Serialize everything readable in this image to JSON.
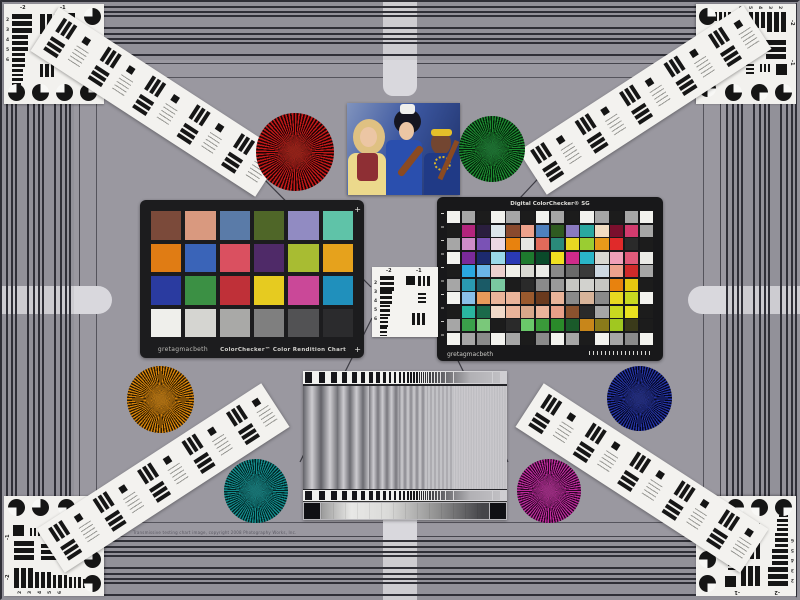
{
  "scene": {
    "bg_color": "#9a98a0",
    "stripe_color": "#2f2f37",
    "arm_color": "#d9d8dd",
    "copyright": "Transmissive testing chart image, copyright 2008 Photography Works, Inc."
  },
  "left_chart": {
    "brand": "gretagmacbeth",
    "title": "ColorChecker™ Color Rendition Chart",
    "rows": [
      [
        "#7b4a3a",
        "#d9997f",
        "#5a7ba8",
        "#4f6628",
        "#918bc2",
        "#5fc3a8"
      ],
      [
        "#e07c14",
        "#3a64b8",
        "#da5060",
        "#4f2a68",
        "#a8bc32",
        "#e6a21c"
      ],
      [
        "#2a3ba0",
        "#3b9044",
        "#bf3038",
        "#e6cb20",
        "#ca4898",
        "#2090bc"
      ],
      [
        "#efefeb",
        "#d5d5d1",
        "#a9a9a7",
        "#7f7f7f",
        "#525254",
        "#2b2b2d"
      ]
    ]
  },
  "sg_chart": {
    "brand": "gretagmacbeth",
    "title": "Digital ColorChecker® SG",
    "rows": [
      [
        "#f2f2ee",
        "#a6a6a6",
        "#1c1c1c",
        "#f2f2ee",
        "#a6a6a6",
        "#1c1c1c",
        "#f2f2ee",
        "#a6a6a6",
        "#1c1c1c",
        "#f2f2ee",
        "#a6a6a6",
        "#1c1c1c",
        "#a6a6a6",
        "#f2f2ee"
      ],
      [
        "#1c1c1c",
        "#b2247c",
        "#2a1e3e",
        "#dde6ea",
        "#8a4a2e",
        "#eda28c",
        "#4f81bd",
        "#2f5b21",
        "#8a7ac0",
        "#2aa8a0",
        "#f2ddc2",
        "#7a0f2d",
        "#d23b6e",
        "#a6a6a6"
      ],
      [
        "#a6a6a6",
        "#cf8cc8",
        "#7a52b5",
        "#ecd8e2",
        "#e8820e",
        "#e6e6e2",
        "#e06a5a",
        "#2a8a7a",
        "#e8d822",
        "#9acd32",
        "#e89a1a",
        "#e02a2a",
        "#2a2a2a",
        "#1c1c1c"
      ],
      [
        "#f2f2ee",
        "#7a2a9a",
        "#1c2a6e",
        "#9ad8e8",
        "#2a3ab5",
        "#1e7a2e",
        "#0a4a2a",
        "#f0e020",
        "#d02a8a",
        "#2ab5c8",
        "#d8d8d2",
        "#f0a0b8",
        "#e05a7a",
        "#eaeae6"
      ],
      [
        "#1c1c1c",
        "#2aa8e0",
        "#6ab5e8",
        "#ecd0ce",
        "#f0f0ea",
        "#d8d8d2",
        "#eaeae6",
        "#8a8a8a",
        "#6a6a6a",
        "#3a3a3a",
        "#cdd8e2",
        "#eda28c",
        "#d02a2a",
        "#a6a6a6"
      ],
      [
        "#a6a6a6",
        "#2a9ab0",
        "#1a5a66",
        "#7ac8a0",
        "#1c1c1c",
        "#2a2a2a",
        "#8a8a8a",
        "#9a9a9a",
        "#c6c6c2",
        "#d2d2ce",
        "#c6c6c2",
        "#e8820e",
        "#e8c810",
        "#1c1c1c"
      ],
      [
        "#f2f2ee",
        "#8ac0e8",
        "#e89a5a",
        "#eab49a",
        "#eab49a",
        "#9a5a2e",
        "#6a3a1e",
        "#eab49a",
        "#8a8a8a",
        "#d8b49a",
        "#8a8a8a",
        "#e8d820",
        "#c8d820",
        "#f2f2ee"
      ],
      [
        "#1c1c1c",
        "#2ab5a0",
        "#1a6a4a",
        "#f0d8c8",
        "#eab49a",
        "#d8a88a",
        "#eab49a",
        "#e8a088",
        "#8a522e",
        "#2a2a2a",
        "#a6a6a6",
        "#c8d820",
        "#e8e020",
        "#1c1c1c"
      ],
      [
        "#a6a6a6",
        "#3aa04a",
        "#7ac87a",
        "#1c1c1c",
        "#2a2a2a",
        "#6ac86a",
        "#3a9a3a",
        "#2a8a2a",
        "#1a5a2a",
        "#c8861a",
        "#8a7a1a",
        "#a0c820",
        "#3a3a1a",
        "#1c1c1c"
      ],
      [
        "#f2f2ee",
        "#a6a6a6",
        "#8a8a8a",
        "#f2f2ee",
        "#a6a6a6",
        "#1c1c1c",
        "#8a8a8a",
        "#f2f2ee",
        "#a6a6a6",
        "#1c1c1c",
        "#f2f2ee",
        "#a6a6a6",
        "#8a8a8a",
        "#f2f2ee"
      ]
    ]
  },
  "usaf": {
    "top_labels": [
      "-2",
      "-1"
    ],
    "side_labels": [
      "2",
      "3",
      "4",
      "5",
      "6"
    ]
  },
  "stars": [
    {
      "name": "red-star",
      "x": 256,
      "y": 113,
      "d": 78,
      "color": "#c01818",
      "dark": "#1e0404",
      "mid": "rgba(145,35,25,0.9)"
    },
    {
      "name": "green-star",
      "x": 459,
      "y": 116,
      "d": 66,
      "color": "#1c8a30",
      "dark": "#04200a",
      "mid": "rgba(30,110,50,0.9)"
    },
    {
      "name": "orange-star",
      "x": 127,
      "y": 366,
      "d": 67,
      "color": "#d4820a",
      "dark": "#2a1a02",
      "mid": "rgba(170,110,20,0.9)"
    },
    {
      "name": "navy-star",
      "x": 607,
      "y": 366,
      "d": 65,
      "color": "#2433a2",
      "dark": "#04061e",
      "mid": "rgba(35,45,120,0.9)"
    },
    {
      "name": "teal-star",
      "x": 224,
      "y": 459,
      "d": 64,
      "color": "#138c8c",
      "dark": "#022424",
      "mid": "rgba(25,115,115,0.9)"
    },
    {
      "name": "magenta-star",
      "x": 517,
      "y": 459,
      "d": 64,
      "color": "#bc2a9c",
      "dark": "#2a0624",
      "mid": "rgba(150,45,125,0.9)"
    }
  ],
  "photo": {
    "palette": {
      "backdrop_light": "#8093bd",
      "backdrop_dark": "#1d2f66",
      "skin_light": "#ecc6a4",
      "skin_dark": "#734631",
      "hair_blonde": "#dfc182",
      "hair_black": "#151520",
      "dress_yellow": "#ecd98c",
      "vest_red": "#8e2f34",
      "dress_blue": "#2a4fae",
      "bow_white": "#efefec",
      "headband_yellow": "#e4bf2a",
      "garment_blue": "#203a86",
      "necklace_gold": "#d8b42a",
      "violin_brown": "#8a4a22"
    }
  }
}
